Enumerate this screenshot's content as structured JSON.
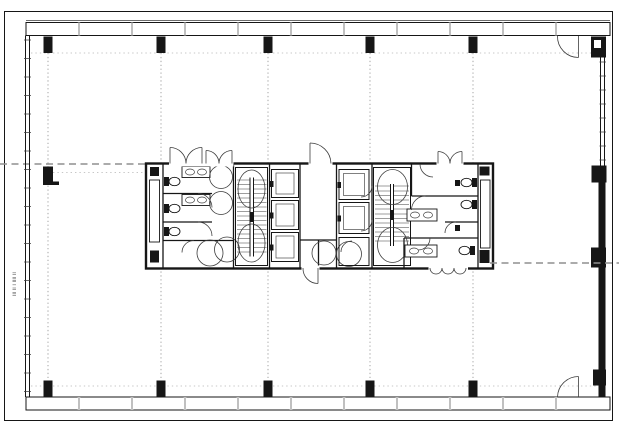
{
  "colors": {
    "paper": "#ffffff",
    "line": "#161616",
    "soft": "#3d3d3d",
    "grid": "#8f8f8f",
    "hatchdark": "#4a4a4a",
    "hatchmid": "#9d9d9d"
  },
  "margin_note": {
    "text": "lll ll l llll ll"
  }
}
